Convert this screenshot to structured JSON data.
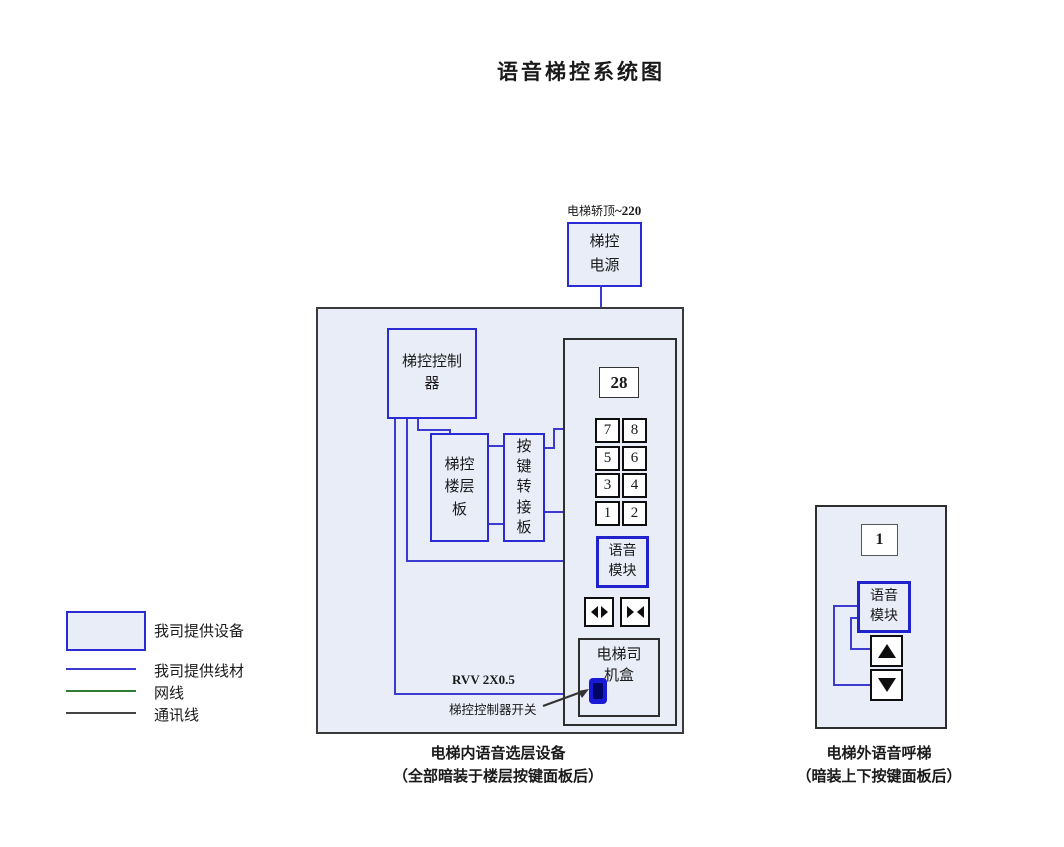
{
  "title": "语音梯控系统图",
  "colors": {
    "device_fill": "#e9edf8",
    "device_border_blue": "#2b2bd5",
    "wire_blue": "#3b3bd0",
    "net_green": "#2e7d32",
    "comm_dark": "#444444",
    "box_border_dark": "#3a3a3a"
  },
  "power": {
    "location_note": "电梯轿顶",
    "voltage": "~220",
    "box_label": "梯控\n电源"
  },
  "cabin_unit": {
    "controller_label": "梯控控制\n器",
    "floor_board_label": "梯控\n楼层\n板",
    "key_adapter_label": "按\n键\n转\n接\n板",
    "panel": {
      "display_value": "28",
      "buttons": [
        "7",
        "8",
        "5",
        "6",
        "3",
        "4",
        "1",
        "2"
      ],
      "voice_module_label": "语音\n模块",
      "driver_box_label": "电梯司\n机盒"
    },
    "cable_label": "RVV 2X0.5",
    "switch_label": "梯控控制器开关",
    "caption_line1": "电梯内语音选层设备",
    "caption_line2": "（全部暗装于楼层按键面板后）"
  },
  "hall_unit": {
    "display_value": "1",
    "voice_module_label": "语音\n模块",
    "caption_line1": "电梯外语音呼梯",
    "caption_line2": "（暗装上下按键面板后）"
  },
  "legend": {
    "items": [
      {
        "type": "box",
        "label": "我司提供设备",
        "color": "#2b2bd5"
      },
      {
        "type": "line",
        "label": "我司提供线材",
        "color": "#3b3bd0"
      },
      {
        "type": "line",
        "label": "网线",
        "color": "#2e7d32"
      },
      {
        "type": "line",
        "label": "通讯线",
        "color": "#444444"
      }
    ]
  }
}
